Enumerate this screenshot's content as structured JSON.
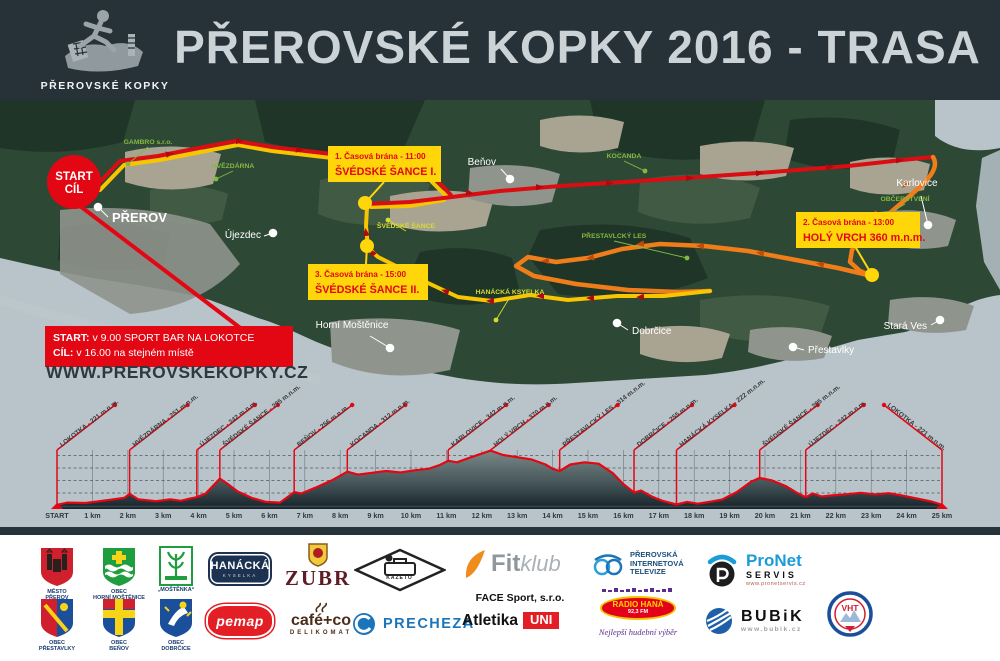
{
  "header": {
    "title": "PŘEROVSKÉ KOPKY 2016 - TRASA",
    "logo_caption": "PŘEROVSKÉ KOPKY"
  },
  "map": {
    "start_circle": {
      "line1": "START",
      "line2": "CÍL",
      "cx": 74,
      "cy": 182,
      "r": 27
    },
    "info_box": {
      "label1": "START:",
      "text1": "v 9.00 SPORT BAR NA LOKOTCE",
      "label2": "CÍL:",
      "text2": "v 16.00 na stejném místě"
    },
    "website": "WWW.PREROVSKEKOPKY.CZ",
    "towns": [
      {
        "name": "PŘEROV",
        "x": 98,
        "y": 207,
        "lx": 112,
        "ly": 222,
        "lex": 108,
        "ley": 217,
        "big": true
      },
      {
        "name": "Újezdec",
        "x": 273,
        "y": 233,
        "lx": 261,
        "ly": 238,
        "lex": 264,
        "ley": 236,
        "a": "end"
      },
      {
        "name": "Beňov",
        "x": 510,
        "y": 179,
        "lx": 496,
        "ly": 165,
        "lex": 501,
        "ley": 169,
        "a": "end"
      },
      {
        "name": "Horní Moštěnice",
        "x": 390,
        "y": 348,
        "lx": 352,
        "ly": 328,
        "lex": 370,
        "ley": 336,
        "a": "middle"
      },
      {
        "name": "Dobrčice",
        "x": 617,
        "y": 323,
        "lx": 632,
        "ly": 334,
        "lex": 628,
        "ley": 330
      },
      {
        "name": "Přestavlky",
        "x": 793,
        "y": 347,
        "lx": 808,
        "ly": 353,
        "lex": 804,
        "ley": 350
      },
      {
        "name": "Stará Ves",
        "x": 940,
        "y": 320,
        "lx": 927,
        "ly": 329,
        "lex": 931,
        "ley": 325,
        "a": "end"
      },
      {
        "name": "Karlovice",
        "x": 928,
        "y": 225,
        "lx": 917,
        "ly": 186,
        "lex": 921,
        "ley": 196,
        "a": "middle"
      }
    ],
    "pois": [
      {
        "t": "GAMBRO s.r.o.",
        "x": 148,
        "y": 144,
        "color": "green",
        "dx": 128,
        "dy": 164
      },
      {
        "t": "HVĚZDÁRNA",
        "x": 233,
        "y": 168,
        "color": "green",
        "dx": 216,
        "dy": 179
      },
      {
        "t": "KOCANDA",
        "x": 624,
        "y": 158,
        "color": "green",
        "dx": 645,
        "dy": 171
      },
      {
        "t": "PŘESTAVLCKÝ LES",
        "x": 614,
        "y": 238,
        "color": "green",
        "dx": 687,
        "dy": 258
      },
      {
        "t": "OBČERSTVENÍ",
        "x": 905,
        "y": 201,
        "color": "green",
        "dx": 866,
        "dy": 227
      },
      {
        "t": "ŠVÉDSKÉ ŠANCE",
        "x": 406,
        "y": 228,
        "color": "yellow",
        "dx": 388,
        "dy": 220
      },
      {
        "t": "HANÁCKÁ KSYELKA",
        "x": 510,
        "y": 294,
        "color": "yellow",
        "dx": 496,
        "dy": 320
      }
    ],
    "gates": [
      {
        "t1": "1. Časová brána - 11:00",
        "t2": "ŠVÉDSKÉ ŠANCE I.",
        "bx": 328,
        "by": 146,
        "w": 113,
        "cx": 365,
        "cy": 203,
        "lx": 384,
        "ly": 182
      },
      {
        "t1": "2. Časová brána - 13:00",
        "t2": "HOLÝ VRCH 360 m.n.m.",
        "bx": 796,
        "by": 212,
        "w": 124,
        "cx": 872,
        "cy": 275,
        "lx": 856,
        "ly": 248
      },
      {
        "t1": "3. Časová brána - 15:00",
        "t2": "ŠVÉDSKÉ ŠANCE II.",
        "bx": 308,
        "by": 264,
        "w": 120,
        "cx": 367,
        "cy": 246,
        "lx": 366,
        "ly": 264
      }
    ]
  },
  "chart_data": {
    "type": "area",
    "title": "Elevation profile of the 25 km course",
    "xlabel": "km",
    "ylabel": "m n.m.",
    "ylim": [
      215,
      380
    ],
    "grid": true,
    "line_color": "#e30613",
    "x_ticks": [
      "START",
      "1 km",
      "2 km",
      "3 km",
      "4 km",
      "5 km",
      "6 km",
      "7 km",
      "8 km",
      "9 km",
      "10 km",
      "11 km",
      "12 km",
      "13 km",
      "14 km",
      "15 km",
      "16 km",
      "17 km",
      "18 km",
      "19 km",
      "20 km",
      "21 km",
      "22 km",
      "23 km",
      "24 km",
      "25 km"
    ],
    "profile_points": [
      [
        0,
        221
      ],
      [
        0.3,
        227
      ],
      [
        0.8,
        226
      ],
      [
        1.2,
        231
      ],
      [
        1.6,
        236
      ],
      [
        1.9,
        240
      ],
      [
        2.05,
        251
      ],
      [
        2.3,
        236
      ],
      [
        2.8,
        231
      ],
      [
        3.2,
        236
      ],
      [
        3.5,
        232
      ],
      [
        3.75,
        238
      ],
      [
        3.95,
        242
      ],
      [
        4.2,
        252
      ],
      [
        4.6,
        293
      ],
      [
        4.8,
        280
      ],
      [
        5.1,
        258
      ],
      [
        5.5,
        240
      ],
      [
        5.9,
        229
      ],
      [
        6.3,
        227
      ],
      [
        6.55,
        245
      ],
      [
        6.7,
        256
      ],
      [
        6.9,
        252
      ],
      [
        7.3,
        268
      ],
      [
        7.8,
        290
      ],
      [
        8.2,
        312
      ],
      [
        8.5,
        304
      ],
      [
        8.9,
        309
      ],
      [
        9.3,
        314
      ],
      [
        9.7,
        310
      ],
      [
        10.1,
        316
      ],
      [
        10.5,
        320
      ],
      [
        10.8,
        330
      ],
      [
        11.05,
        342
      ],
      [
        11.3,
        338
      ],
      [
        11.7,
        352
      ],
      [
        12.0,
        362
      ],
      [
        12.25,
        370
      ],
      [
        12.6,
        358
      ],
      [
        13.0,
        352
      ],
      [
        13.4,
        346
      ],
      [
        13.8,
        332
      ],
      [
        14.0,
        320
      ],
      [
        14.2,
        314
      ],
      [
        14.5,
        332
      ],
      [
        14.9,
        338
      ],
      [
        15.3,
        334
      ],
      [
        15.7,
        308
      ],
      [
        16.0,
        278
      ],
      [
        16.3,
        255
      ],
      [
        16.5,
        260
      ],
      [
        16.8,
        244
      ],
      [
        17.1,
        232
      ],
      [
        17.5,
        222
      ],
      [
        17.8,
        229
      ],
      [
        18.1,
        224
      ],
      [
        18.5,
        230
      ],
      [
        18.8,
        236
      ],
      [
        19.2,
        256
      ],
      [
        19.6,
        284
      ],
      [
        19.85,
        295
      ],
      [
        20.2,
        288
      ],
      [
        20.6,
        272
      ],
      [
        20.9,
        254
      ],
      [
        21.15,
        242
      ],
      [
        21.35,
        252
      ],
      [
        21.6,
        244
      ],
      [
        21.9,
        247
      ],
      [
        22.3,
        250
      ],
      [
        22.7,
        254
      ],
      [
        23.1,
        250
      ],
      [
        23.5,
        253
      ],
      [
        23.9,
        246
      ],
      [
        24.3,
        238
      ],
      [
        24.7,
        230
      ],
      [
        25,
        221
      ]
    ],
    "peaks": [
      {
        "km": 0,
        "label": "LOKOTKA - 221 m.n.m."
      },
      {
        "km": 2.05,
        "label": "HVĚZDÁRNA - 251 m.n.m."
      },
      {
        "km": 3.95,
        "label": "ÚJEZDEC - 242 m.n.m."
      },
      {
        "km": 4.6,
        "label": "ŠVÉDSKÉ ŠANCE - 295 m.n.m."
      },
      {
        "km": 6.7,
        "label": "BEŇOV - 256 m.n.m."
      },
      {
        "km": 8.2,
        "label": "KOCANDA - 312 m.n.m."
      },
      {
        "km": 11.05,
        "label": "KARLOVICE - 342 m.n.m."
      },
      {
        "km": 12.25,
        "label": "HOLÝ VRCH - 370 m.n.m."
      },
      {
        "km": 14.2,
        "label": "PŘESTAVLCKÝ LES - 314 m.n.m."
      },
      {
        "km": 16.3,
        "label": "DOBRČICE - 255 m.n.m."
      },
      {
        "km": 17.5,
        "label": "HANÁCKÁ KYSELKA - 222 m.n.m."
      },
      {
        "km": 19.85,
        "label": "ŠVÉDSKÉ ŠANCE - 295 m.n.m."
      },
      {
        "km": 21.15,
        "label": "ÚJEZDEC - 242 m.n.m."
      },
      {
        "km": 25,
        "label": "LOKOTKA - 221 m.n.m."
      }
    ]
  },
  "sponsors": {
    "items": [
      {
        "id": "mesto-prerov",
        "x": 28,
        "y": 546,
        "w": 58,
        "icon": "shield-prerov",
        "lines": [
          {
            "t": "MĚSTO",
            "c": "crest-cap"
          },
          {
            "t": "PŘEROV",
            "c": "crest-cap"
          }
        ]
      },
      {
        "id": "obec-horni-mostenice",
        "x": 88,
        "y": 546,
        "w": 62,
        "icon": "shield-hm",
        "lines": [
          {
            "t": "OBEC",
            "c": "crest-cap"
          },
          {
            "t": "HORNÍ MOŠTĚNICE",
            "c": "crest-cap"
          }
        ]
      },
      {
        "id": "mostenka",
        "x": 150,
        "y": 546,
        "w": 52,
        "icon": "mostenka",
        "lines": [
          {
            "t": "„MOŠTĚNKA“",
            "c": "crest-cap"
          }
        ]
      },
      {
        "id": "hanacka-kyselka",
        "x": 208,
        "y": 552,
        "w": 64,
        "cls": "hanacka",
        "lines": [
          {
            "t": "HANÁCKÁ",
            "c": "hanacka-main"
          },
          {
            "t": "KYSELKA",
            "c": "hanacka-sub"
          }
        ]
      },
      {
        "id": "zubr",
        "x": 282,
        "y": 542,
        "w": 72,
        "icon": "zubr-emblem",
        "lines": [
          {
            "t": "ZUBR",
            "c": "zubr-name"
          }
        ]
      },
      {
        "id": "kazeto",
        "x": 352,
        "y": 548,
        "w": 95,
        "cls": "kazeto",
        "icon": "kazeto",
        "lines": [
          {
            "t": "KAZETO",
            "c": "kazeto-text"
          }
        ]
      },
      {
        "id": "fitklub",
        "x": 462,
        "y": 546,
        "w": 115,
        "cls": "fitklub",
        "icon": "fitswoosh",
        "lines": [
          {
            "t": "Fit",
            "c": "fit-bold"
          },
          {
            "t": "klub",
            "c": "fit-italic"
          }
        ]
      },
      {
        "id": "face-sport",
        "x": 464,
        "y": 592,
        "w": 112,
        "lines": [
          {
            "t": "FACE Sport, s.r.o.",
            "c": "face-name"
          }
        ]
      },
      {
        "id": "prerovska-tv",
        "x": 592,
        "y": 550,
        "w": 92,
        "cls": "tv",
        "icon": "tvicon",
        "lines": [
          {
            "t": "PŘEROVSKÁ",
            "c": "tv-line"
          },
          {
            "t": "INTERNETOVÁ",
            "c": "tv-line"
          },
          {
            "t": "TELEVIZE",
            "c": "tv-line"
          }
        ]
      },
      {
        "id": "pronet-servis",
        "x": 704,
        "y": 550,
        "w": 112,
        "cls": "pronet",
        "icon": "pronet-icon",
        "lines": [
          {
            "t": "ProNet",
            "c": "pronet-name"
          },
          {
            "t": "SERVIS",
            "c": "pronet-sub"
          },
          {
            "t": "www.pronetservis.cz",
            "c": "pronet-url"
          }
        ]
      },
      {
        "id": "kct-vht",
        "x": 826,
        "y": 546,
        "w": 48,
        "cls": "kct",
        "icon": "kct-badge",
        "lines": [
          {
            "t": "VHT",
            "c": "kct-vht"
          }
        ]
      },
      {
        "id": "obec-prestavlky",
        "x": 28,
        "y": 597,
        "w": 58,
        "icon": "shield-prestavlky",
        "lines": [
          {
            "t": "OBEC",
            "c": "crest-cap"
          },
          {
            "t": "PŘESTAVLKY",
            "c": "crest-cap"
          }
        ]
      },
      {
        "id": "obec-benov",
        "x": 88,
        "y": 597,
        "w": 62,
        "icon": "shield-benov",
        "lines": [
          {
            "t": "OBEC",
            "c": "crest-cap"
          },
          {
            "t": "BEŇOV",
            "c": "crest-cap"
          }
        ]
      },
      {
        "id": "obec-dobrcice",
        "x": 150,
        "y": 597,
        "w": 52,
        "icon": "shield-dobrcice",
        "lines": [
          {
            "t": "OBEC",
            "c": "crest-cap"
          },
          {
            "t": "DOBRČICE",
            "c": "crest-cap"
          }
        ]
      },
      {
        "id": "pemap",
        "x": 208,
        "y": 606,
        "w": 64,
        "cls": "pemap",
        "lines": [
          {
            "t": "pemap",
            "c": "pemap-name"
          }
        ]
      },
      {
        "id": "cafe-co-delikomat",
        "x": 282,
        "y": 602,
        "w": 78,
        "icon": "cafeco-steam",
        "lines": [
          {
            "t": "café+co",
            "c": "cafeco-name"
          },
          {
            "t": "DELIKOMAT",
            "c": "cafeco-sub"
          }
        ]
      },
      {
        "id": "precheza",
        "x": 352,
        "y": 612,
        "w": 106,
        "cls": "precheza",
        "icon": "precheza-icon",
        "lines": [
          {
            "t": "PRECHEZA",
            "c": "precheza-name"
          }
        ]
      },
      {
        "id": "atletika-uni",
        "x": 462,
        "y": 612,
        "w": 116,
        "cls": "atl",
        "lines": [
          {
            "t": "Atletika",
            "c": "atl-name"
          },
          {
            "t": "UNI",
            "c": "atl-uni"
          }
        ]
      },
      {
        "id": "radio-hana",
        "x": 592,
        "y": 588,
        "w": 92,
        "cls": "radiohana",
        "icon": "eqline",
        "lines": [
          {
            "t": "RADIO HANÁ",
            "c": "rh1"
          },
          {
            "t": "92,3 FM",
            "c": "rh2"
          }
        ]
      },
      {
        "id": "radio-hana-slogan",
        "x": 588,
        "y": 628,
        "w": 100,
        "lines": [
          {
            "t": "Nejlepší hudební výběr",
            "c": "rh-script"
          }
        ]
      },
      {
        "id": "bubik",
        "x": 704,
        "y": 606,
        "w": 114,
        "cls": "bubik",
        "icon": "bubik-globe",
        "lines": [
          {
            "t": "BUBiK",
            "c": "bubik-name"
          },
          {
            "t": "www.bubik.cz",
            "c": "bubik-url"
          }
        ]
      }
    ]
  }
}
